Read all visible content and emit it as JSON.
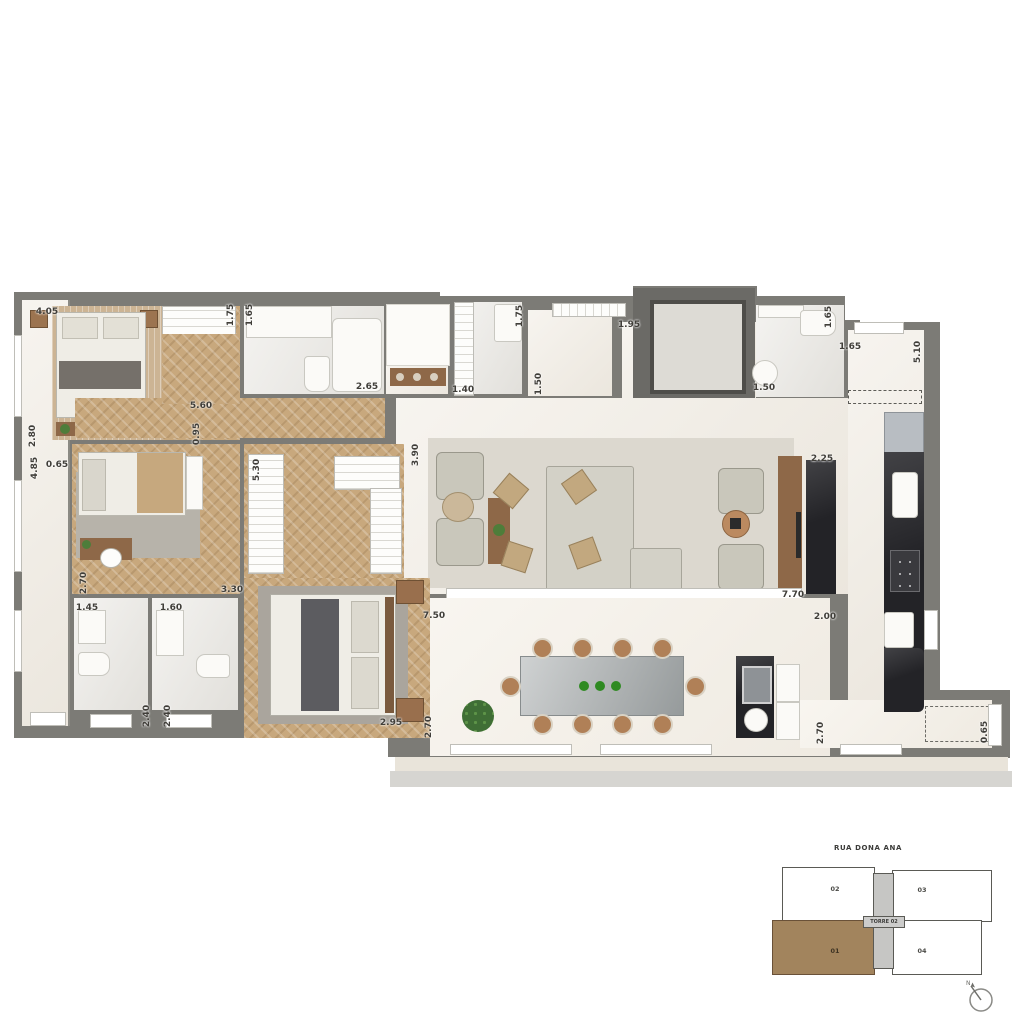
{
  "floorplan": {
    "colors": {
      "wall": "#7c7b76",
      "wood_floor": "#c8a87d",
      "marble_floor": "#f0ebe2",
      "terrace_floor": "#f4efe6",
      "black_counter": "#232327",
      "highlight_unit": "#a2845d"
    },
    "dimension_labels": [
      {
        "text": "4.05",
        "x": 47,
        "y": 312,
        "v": false
      },
      {
        "text": "1.75",
        "x": 231,
        "y": 315,
        "v": true
      },
      {
        "text": "1.65",
        "x": 250,
        "y": 315,
        "v": true
      },
      {
        "text": "2.65",
        "x": 367,
        "y": 387,
        "v": false
      },
      {
        "text": "2.80",
        "x": 33,
        "y": 436,
        "v": true
      },
      {
        "text": "4.85",
        "x": 35,
        "y": 468,
        "v": true
      },
      {
        "text": "0.65",
        "x": 57,
        "y": 465,
        "v": false
      },
      {
        "text": "5.60",
        "x": 201,
        "y": 406,
        "v": false
      },
      {
        "text": "0.95",
        "x": 197,
        "y": 434,
        "v": true
      },
      {
        "text": "5.30",
        "x": 257,
        "y": 470,
        "v": true
      },
      {
        "text": "2.70",
        "x": 84,
        "y": 583,
        "v": true
      },
      {
        "text": "3.30",
        "x": 232,
        "y": 590,
        "v": false
      },
      {
        "text": "1.45",
        "x": 87,
        "y": 608,
        "v": false
      },
      {
        "text": "1.60",
        "x": 171,
        "y": 608,
        "v": false
      },
      {
        "text": "2.40",
        "x": 147,
        "y": 716,
        "v": true
      },
      {
        "text": "2.40",
        "x": 168,
        "y": 716,
        "v": true
      },
      {
        "text": "2.95",
        "x": 391,
        "y": 723,
        "v": false
      },
      {
        "text": "3.90",
        "x": 416,
        "y": 455,
        "v": true
      },
      {
        "text": "1.40",
        "x": 463,
        "y": 390,
        "v": false
      },
      {
        "text": "1.75",
        "x": 520,
        "y": 316,
        "v": true
      },
      {
        "text": "1.50",
        "x": 539,
        "y": 384,
        "v": true
      },
      {
        "text": "1.95",
        "x": 629,
        "y": 325,
        "v": false
      },
      {
        "text": "1.50",
        "x": 764,
        "y": 388,
        "v": false
      },
      {
        "text": "1.65",
        "x": 829,
        "y": 317,
        "v": true
      },
      {
        "text": "1.65",
        "x": 850,
        "y": 347,
        "v": false
      },
      {
        "text": "5.10",
        "x": 918,
        "y": 352,
        "v": true
      },
      {
        "text": "2.25",
        "x": 822,
        "y": 459,
        "v": false
      },
      {
        "text": "7.70",
        "x": 793,
        "y": 595,
        "v": false
      },
      {
        "text": "2.00",
        "x": 825,
        "y": 617,
        "v": false
      },
      {
        "text": "7.50",
        "x": 434,
        "y": 616,
        "v": false
      },
      {
        "text": "2.70",
        "x": 429,
        "y": 727,
        "v": true
      },
      {
        "text": "2.70",
        "x": 821,
        "y": 733,
        "v": true
      },
      {
        "text": "0.65",
        "x": 985,
        "y": 732,
        "v": true
      }
    ]
  },
  "keyplan": {
    "street": "RUA DONA ANA",
    "tower_label": "TORRE 02",
    "highlighted_unit": "01",
    "units": [
      {
        "label": "02"
      },
      {
        "label": "03"
      },
      {
        "label": "01"
      },
      {
        "label": "04"
      }
    ],
    "compass": "north-arrow"
  }
}
